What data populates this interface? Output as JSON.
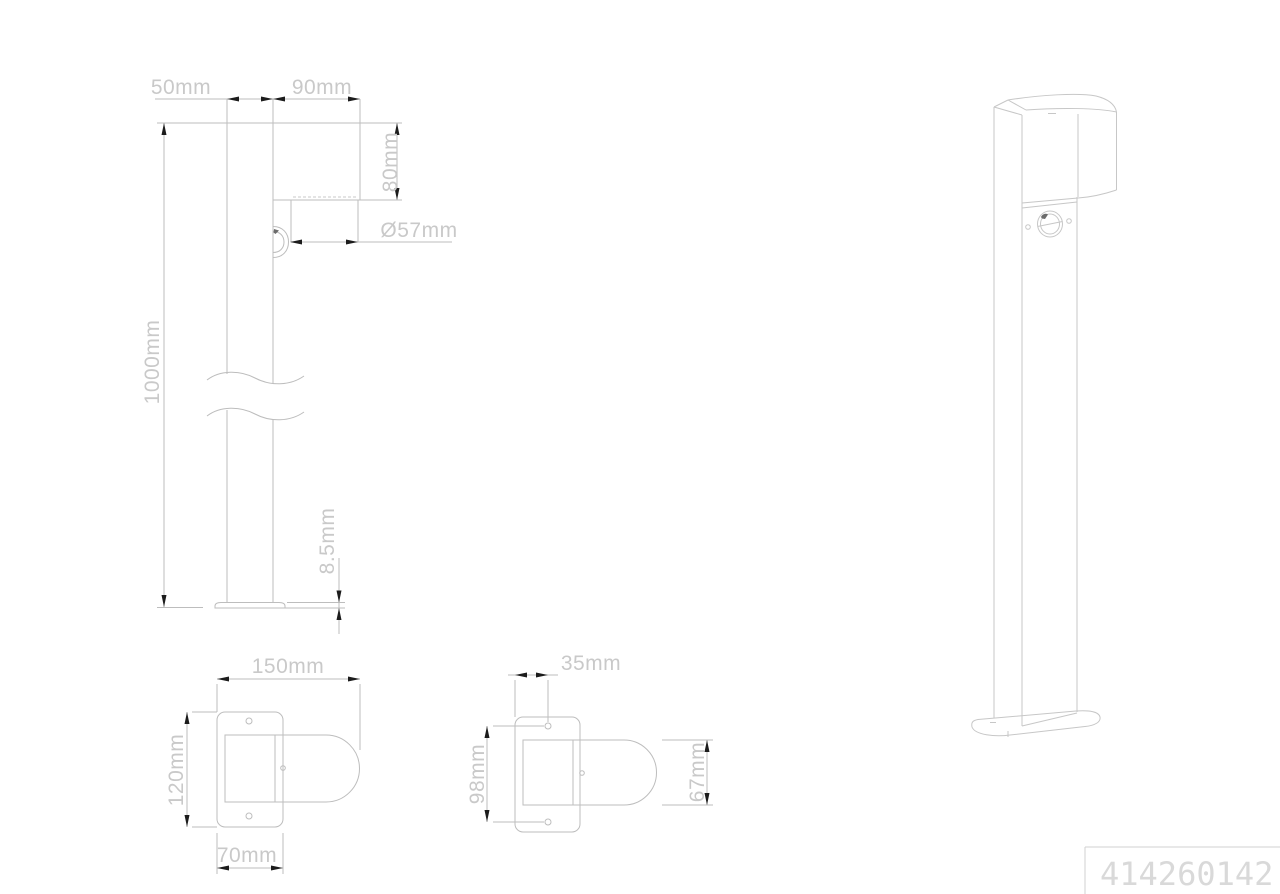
{
  "colors": {
    "background": "#ffffff",
    "drawing_line": "#bdbdbd",
    "perspective_line": "#c7c7c7",
    "dimension_text": "#c9c9c9",
    "arrow": "#1c1c1c",
    "title_text": "#d9d9d9",
    "title_border": "#d2d2d2"
  },
  "dimensions": {
    "side_view": {
      "pole_depth": "50mm",
      "head_depth": "90mm",
      "head_height": "80mm",
      "lens_diameter": "Ø57mm",
      "overall_height": "1000mm",
      "base_plate_thickness": "8.5mm"
    },
    "base_top_view": {
      "overall_depth": "150mm",
      "plate_length": "120mm",
      "plate_width": "70mm"
    },
    "mounting_top_view": {
      "hole_offset": "35mm",
      "hole_spacing": "98mm",
      "head_width": "67mm"
    }
  },
  "title_block": {
    "article_number": "414260142"
  }
}
